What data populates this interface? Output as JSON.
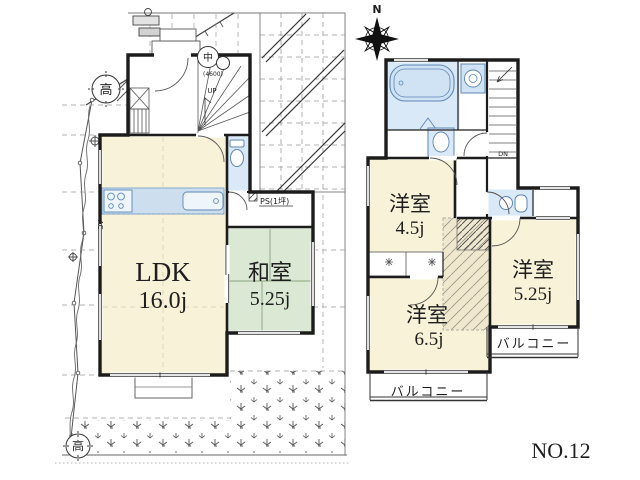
{
  "colors": {
    "room_fill": "#f7f2d8",
    "tatami_fill": "#dbe8d3",
    "fixture_fill": "#d9e9f7",
    "fixture_deep": "#c9def1",
    "wall": "#1c1c1c",
    "hatch_fill": "#efe8cf"
  },
  "compass": {
    "north": "N"
  },
  "plan_number": "NO.12",
  "floor1": {
    "ldk_name": "LDK",
    "ldk_area": "16.0j",
    "washitsu_name": "和室",
    "washitsu_area": "5.25j",
    "ps_label": "PS(1坪)",
    "stair_label": "UP",
    "marker_naka": "中",
    "marker_naka_value": "(4600)",
    "marker_taka_upper": "高",
    "marker_taka_lower": "高",
    "ac_label": "AC"
  },
  "floor2": {
    "room_a_name": "洋室",
    "room_a_area": "4.5j",
    "room_b_name": "洋室",
    "room_b_area": "5.25j",
    "room_c_name": "洋室",
    "room_c_area": "6.5j",
    "balcony_south": "バルコニー",
    "balcony_east": "バルコニー",
    "stair_label": "DN"
  }
}
